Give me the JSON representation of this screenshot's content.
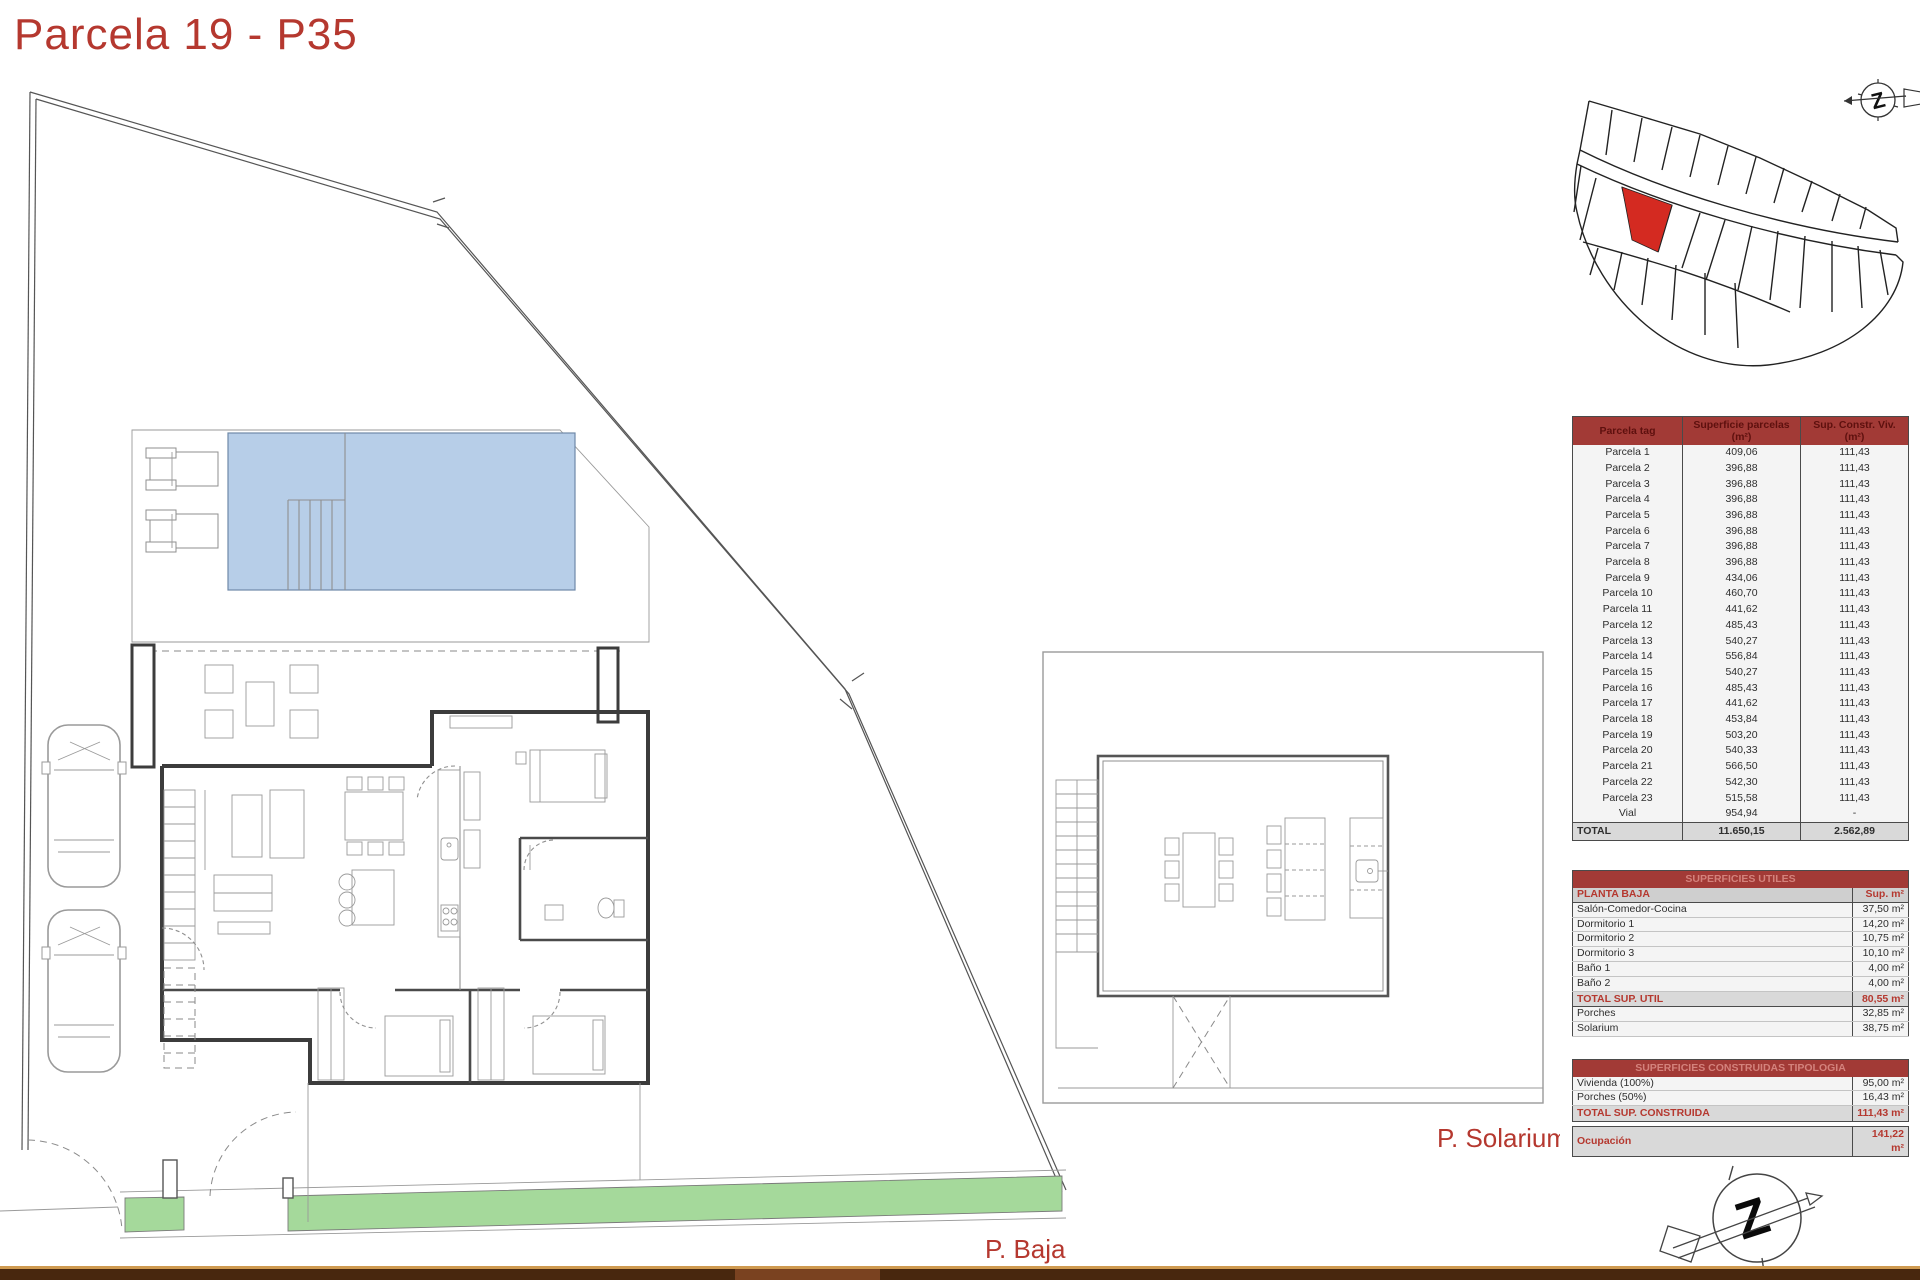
{
  "title": "Parcela 19 - P35",
  "plan_labels": {
    "ground_floor": "P. Baja",
    "solarium": "P. Solarium"
  },
  "parcel_table": {
    "headers": [
      "Parcela tag",
      "Superficie parcelas\n(m²)",
      "Sup. Constr. Viv.\n(m²)"
    ],
    "rows": [
      [
        "Parcela 1",
        "409,06",
        "111,43"
      ],
      [
        "Parcela 2",
        "396,88",
        "111,43"
      ],
      [
        "Parcela 3",
        "396,88",
        "111,43"
      ],
      [
        "Parcela 4",
        "396,88",
        "111,43"
      ],
      [
        "Parcela 5",
        "396,88",
        "111,43"
      ],
      [
        "Parcela 6",
        "396,88",
        "111,43"
      ],
      [
        "Parcela 7",
        "396,88",
        "111,43"
      ],
      [
        "Parcela 8",
        "396,88",
        "111,43"
      ],
      [
        "Parcela 9",
        "434,06",
        "111,43"
      ],
      [
        "Parcela 10",
        "460,70",
        "111,43"
      ],
      [
        "Parcela 11",
        "441,62",
        "111,43"
      ],
      [
        "Parcela 12",
        "485,43",
        "111,43"
      ],
      [
        "Parcela 13",
        "540,27",
        "111,43"
      ],
      [
        "Parcela 14",
        "556,84",
        "111,43"
      ],
      [
        "Parcela 15",
        "540,27",
        "111,43"
      ],
      [
        "Parcela 16",
        "485,43",
        "111,43"
      ],
      [
        "Parcela 17",
        "441,62",
        "111,43"
      ],
      [
        "Parcela 18",
        "453,84",
        "111,43"
      ],
      [
        "Parcela 19",
        "503,20",
        "111,43"
      ],
      [
        "Parcela 20",
        "540,33",
        "111,43"
      ],
      [
        "Parcela 21",
        "566,50",
        "111,43"
      ],
      [
        "Parcela 22",
        "542,30",
        "111,43"
      ],
      [
        "Parcela 23",
        "515,58",
        "111,43"
      ],
      [
        "Vial",
        "954,94",
        "-"
      ]
    ],
    "total": [
      "TOTAL",
      "11.650,15",
      "2.562,89"
    ]
  },
  "useful_areas_table": {
    "title": "SUPERFICIES UTILES",
    "subheader_left": "PLANTA BAJA",
    "subheader_right": "Sup. m²",
    "rows": [
      [
        "Salón-Comedor-Cocina",
        "37,50 m²"
      ],
      [
        "Dormitorio 1",
        "14,20 m²"
      ],
      [
        "Dormitorio 2",
        "10,75 m²"
      ],
      [
        "Dormitorio 3",
        "10,10 m²"
      ],
      [
        "Baño 1",
        "4,00 m²"
      ],
      [
        "Baño 2",
        "4,00 m²"
      ]
    ],
    "total_label": "TOTAL SUP. UTIL",
    "total_value": "80,55 m²",
    "extra_rows": [
      [
        "Porches",
        "32,85 m²"
      ],
      [
        "Solarium",
        "38,75 m²"
      ]
    ]
  },
  "built_areas_table": {
    "title": "SUPERFICIES CONSTRUIDAS TIPOLOGIA",
    "rows": [
      [
        "Vivienda (100%)",
        "95,00 m²"
      ],
      [
        "Porches (50%)",
        "16,43 m²"
      ]
    ],
    "total_label": "TOTAL SUP. CONSTRUIDA",
    "total_value": "111,43 m²",
    "occupation_label": "Ocupación",
    "occupation_value": "141,22 m²"
  },
  "colors": {
    "accent_red": "#b5382f",
    "table_header_bg": "#a23a36",
    "table_header_text": "#5e100e",
    "table_title_text": "#d4827c",
    "total_row_bg": "#d9d9d9",
    "pool_blue": "#b7cee8",
    "grass_green": "#a5d99b",
    "bar_brown": "#48270e",
    "bar_tan": "#cf9a50",
    "parcel_red": "#d42a21"
  }
}
